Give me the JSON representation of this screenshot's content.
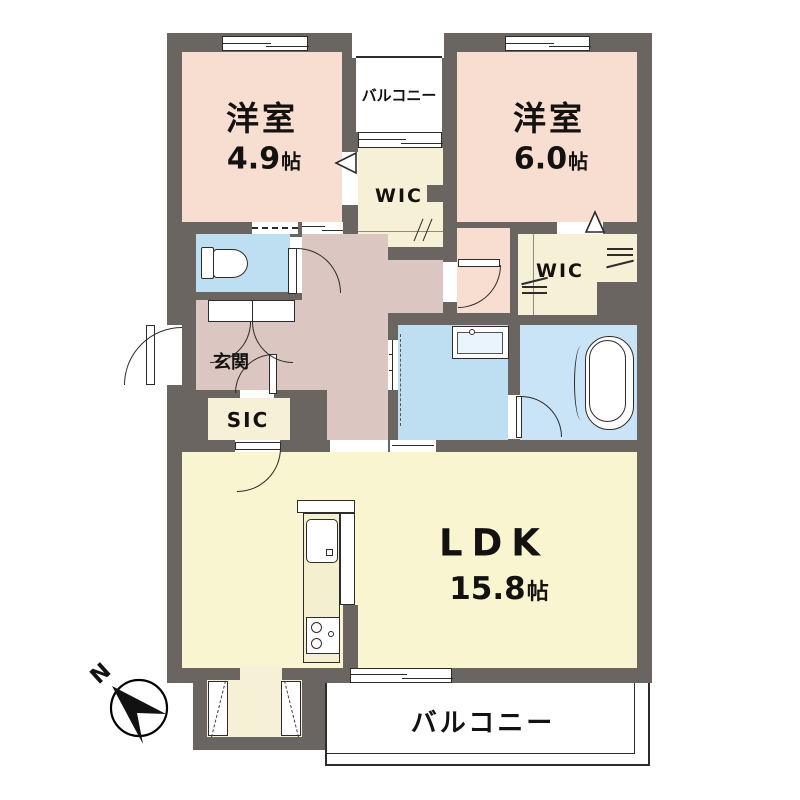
{
  "colors": {
    "wall": "#6a6561",
    "bedroom": "#f8ddd1",
    "hall": "#dcc6c2",
    "closet": "#f6f1d6",
    "ldk": "#f8f5d0",
    "wet": "#bedef2",
    "bath": "#c8e4f6",
    "line": "#2e2c2a"
  },
  "compass": {
    "label": "N"
  },
  "rooms": {
    "bedroom1": {
      "label": "洋室",
      "area": "4.9",
      "unit": "帖"
    },
    "bedroom2": {
      "label": "洋室",
      "area": "6.0",
      "unit": "帖"
    },
    "ldk": {
      "label": "LDK",
      "area": "15.8",
      "unit": "帖"
    },
    "wic1": {
      "label": "WIC"
    },
    "wic2": {
      "label": "WIC"
    },
    "sic": {
      "label": "SIC"
    },
    "genkan": {
      "label": "玄関"
    },
    "balcony_top": {
      "label": "バルコニー"
    },
    "balcony_bottom": {
      "label": "バルコニー"
    }
  }
}
